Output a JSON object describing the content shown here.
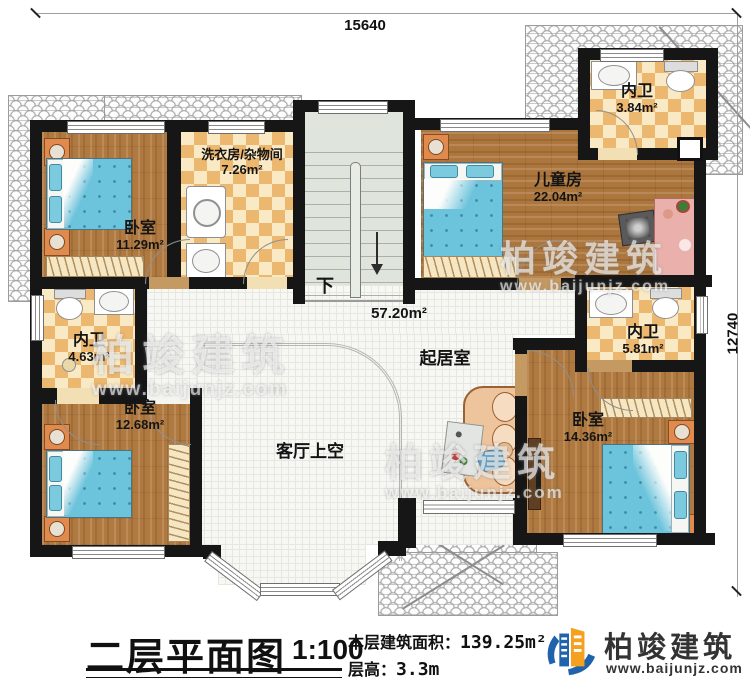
{
  "dimensions": {
    "top": "15640",
    "right": "12740"
  },
  "rooms": [
    {
      "name": "卧室",
      "area": "11.29m²"
    },
    {
      "name": "洗衣房/杂物间",
      "area": "7.26m²"
    },
    {
      "name": "内卫",
      "area": "3.84m²"
    },
    {
      "name": "儿童房",
      "area": "22.04m²"
    },
    {
      "name": "内卫",
      "area": "4.63m²"
    },
    {
      "name": "内卫",
      "area": "5.81m²"
    },
    {
      "name": "起居室",
      "area": "57.20m²"
    },
    {
      "name": "卧室",
      "area": "12.68m²"
    },
    {
      "name": "卧室",
      "area": "14.36m²"
    },
    {
      "name": "客厅上空",
      "area": ""
    }
  ],
  "stairs": {
    "down_label": "下"
  },
  "title_block": {
    "title": "二层平面图",
    "scale": "1:100",
    "area_label": "本层建筑面积：",
    "area_value": "139.25m²",
    "floor_height_label": "层高：",
    "floor_height_value": "3.3m"
  },
  "logo": {
    "name": "柏竣建筑",
    "url": "www.baijunjz.com"
  },
  "watermark": {
    "brand": "柏竣建筑",
    "brand_short": "柏竣建筑",
    "url": "www.baijunjz.com"
  },
  "colors": {
    "wall": "#161616",
    "wood": "#b0793f",
    "tile_dark": "#ecb76f",
    "tile_light": "#f9e9c4",
    "bed": "#6cc3dc",
    "accent_blue": "#1e63ac",
    "accent_orange": "#f5a01e"
  }
}
